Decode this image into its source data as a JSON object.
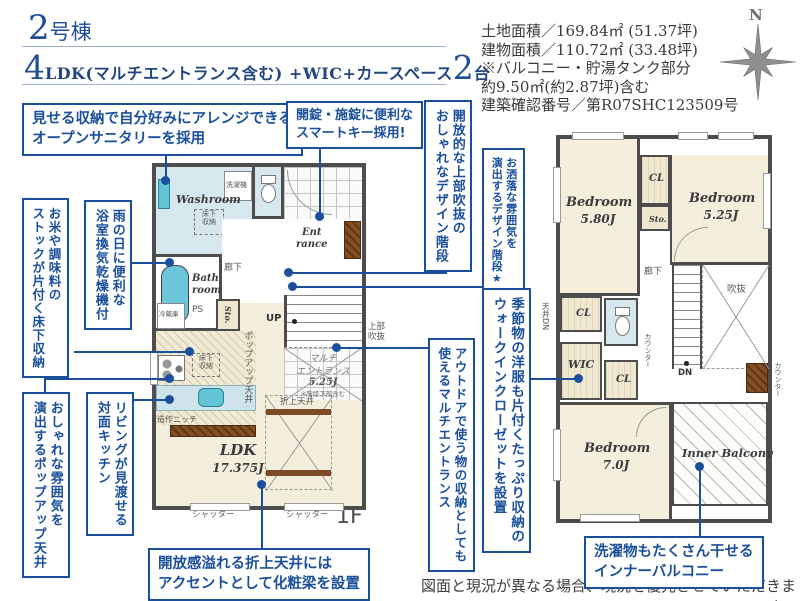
{
  "header": {
    "building_number": "2",
    "building_suffix": "号棟",
    "ldk_big": "4",
    "ldk_text": "LDK(マルチエントランス含む) +WIC+カースペース",
    "cars_big": "2",
    "cars_suffix": "台"
  },
  "site_info": {
    "lines": [
      "土地面積／169.84㎡ (51.37坪)",
      "建物面積／110.72㎡ (33.48坪)",
      "※バルコニー・貯湯タンク部分",
      "約9.50㎡(約2.87坪)含む",
      "建築確認番号／第R07SHC123509号"
    ]
  },
  "compass": {
    "north_label": "N"
  },
  "callouts": {
    "open_sanitary": {
      "line1": "見せる収納で自分好みにアレンジできる",
      "line2": "オープンサニタリーを採用"
    },
    "smart_key": {
      "line1": "開錠・施錠に便利な",
      "line2": "スマートキー採用!"
    },
    "floor_storage": {
      "col1": "お米や調味料の",
      "col2": "ストックが片付く床下収納"
    },
    "bath_dryer": {
      "col1": "雨の日に便利な",
      "col2": "浴室換気乾燥機付"
    },
    "popup_ceiling": {
      "col1": "おしゃれな雰囲気を",
      "col2": "演出するポップアップ天井"
    },
    "face_kitchen": {
      "col1": "リビングが見渡せる",
      "col2": "対面キッチン"
    },
    "void_stairs": {
      "col1": "開放的な上部吹抜の",
      "col2": "おしゃれなデザイン階段"
    },
    "design_stairs": {
      "col1": "お洒落な雰囲気を",
      "col2": "演出するデザイン階段★"
    },
    "multi_entrance": {
      "col1": "アウトドアで使う物の収納としても",
      "col2": "使えるマルチエントランス"
    },
    "wic": {
      "col1": "季節物の洋服も片付くたっぷり収納の",
      "col2": "ウォークインクローゼットを設置"
    },
    "coffered": {
      "line1": "開放感溢れる折上天井には",
      "line2": "アクセントとして化粧梁を設置"
    },
    "inner_balcony": {
      "line1": "洗濯物もたくさん干せる",
      "line2": "インナーバルコニー"
    }
  },
  "floor1": {
    "label": "1F",
    "open_note1": "オープン",
    "open_note2": "サニタリー",
    "open_note3": "irodori",
    "washroom": "Washroom",
    "washer": "洗濯機",
    "underfloor1": "床下",
    "underfloor2": "収納",
    "bath1": "Bath",
    "bath2": "room",
    "sto": "Sto.",
    "hall": "廊下",
    "up": "UP",
    "entrance1": "Ent",
    "entrance2": "rance",
    "multi1": "マルチ",
    "multi2": "エントランス",
    "multi3": "5.25J",
    "multi4": "※階段下部含む",
    "void1": "上部",
    "void2": "吹抜",
    "fridge": "冷蔵庫",
    "ps": "PS",
    "niche": "造作ニッチ",
    "popup": "ポップアップ天井",
    "ldk1": "LDK",
    "ldk2": "17.375J",
    "coffered": "折上天井",
    "shutter": "シャッター"
  },
  "floor2": {
    "label": "2F",
    "bedroom1_1": "Bedroom",
    "bedroom1_2": "5.80J",
    "bedroom2_1": "Bedroom",
    "bedroom2_2": "5.25J",
    "bedroom3_1": "Bedroom",
    "bedroom3_2": "7.0J",
    "cl": "CL",
    "sto": "Sto.",
    "hall": "廊下",
    "void": "吹抜",
    "dn": "DN",
    "ceiling_dn": "天井DN",
    "wic": "WIC",
    "counter": "カウンター",
    "balcony": "Inner Balcony"
  },
  "footer": {
    "disclaimer": "図面と現況が異なる場合、現況を優先させていただきます。"
  },
  "colors": {
    "accent_blue": "#1a4f9c",
    "wall": "#4d4d4d",
    "room_beige": "#f4efdc",
    "room_blue": "#d6e8ee",
    "fixture_teal": "#63c3d7",
    "wood_brown": "#7d4b26"
  }
}
